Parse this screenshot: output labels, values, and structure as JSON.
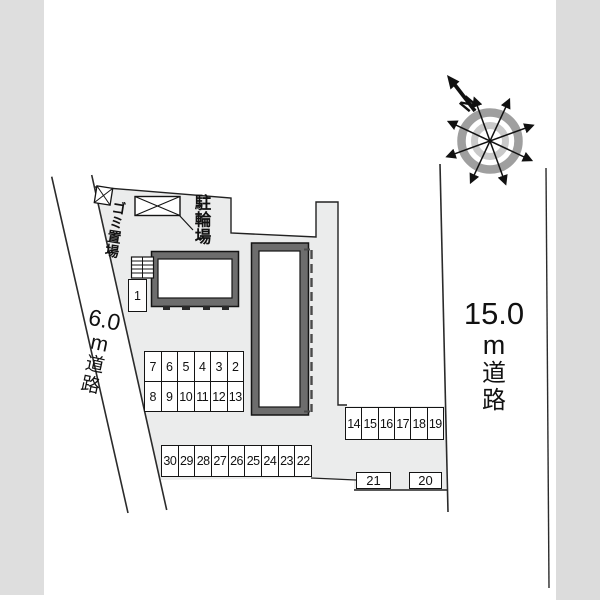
{
  "labels": {
    "bike_parking": "駐輪場",
    "garbage_area": "ゴミ置場",
    "north": "N",
    "left_road": [
      "6.0",
      "m",
      "道",
      "路"
    ],
    "right_road": [
      "15.0",
      "m",
      "道",
      "路"
    ]
  },
  "parking": {
    "row_a1": [
      "7",
      "6",
      "5",
      "4",
      "3",
      "2"
    ],
    "row_a2": [
      "8",
      "9",
      "10",
      "11",
      "12",
      "13"
    ],
    "row_b": [
      "30",
      "29",
      "28",
      "27",
      "26",
      "25",
      "24",
      "23",
      "22"
    ],
    "row_c": [
      "14",
      "15",
      "16",
      "17",
      "18",
      "19"
    ],
    "space_1": "1",
    "space_21": "21",
    "space_20": "20"
  },
  "colors": {
    "outside_band": "#dedede",
    "site_fill": "#ebecec",
    "building_wall": "#6d6d6d",
    "line": "#1a1a1a",
    "compass_outer_ring": "#9f9f9f",
    "compass_inner_ring": "#c9c9c9"
  }
}
